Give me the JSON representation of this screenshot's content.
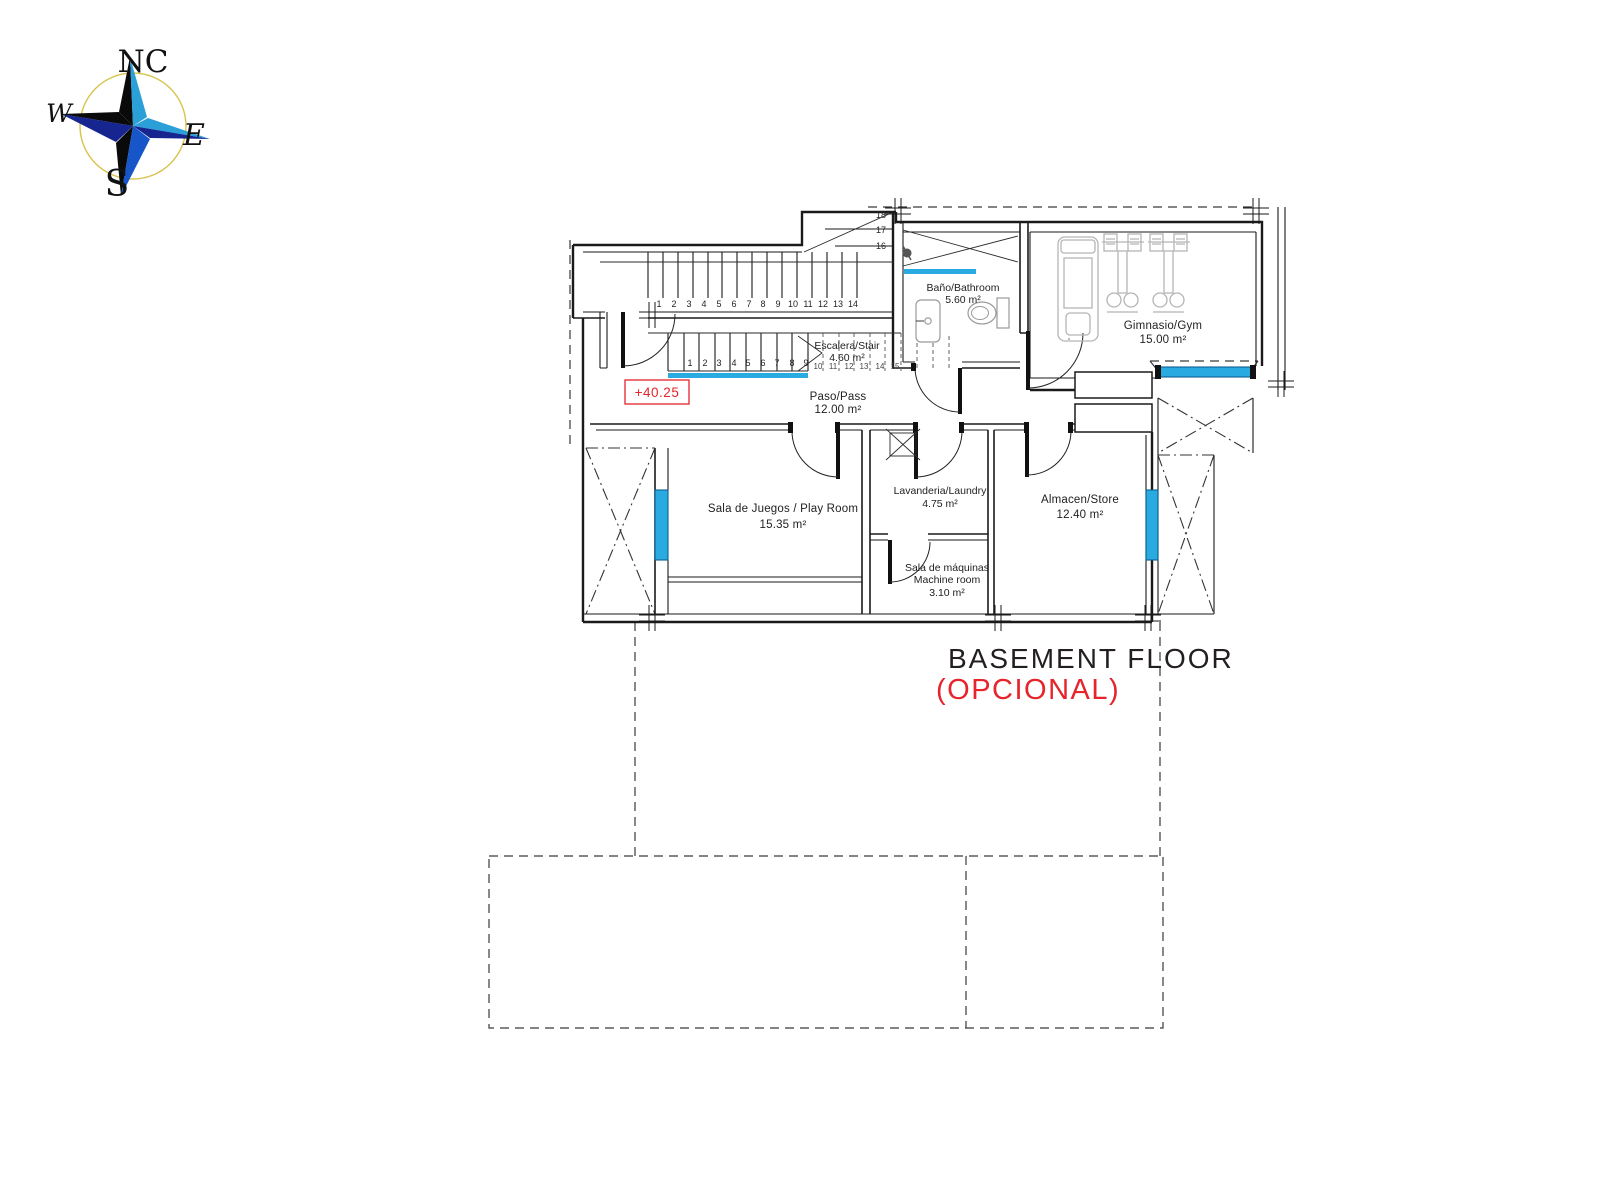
{
  "compass": {
    "n": "NC",
    "w": "W",
    "e": "E",
    "s": "S"
  },
  "plan": {
    "level_marker": "+40.25",
    "rooms": {
      "bathroom": {
        "name": "Baño/Bathroom",
        "area": "5.60 m²"
      },
      "gym": {
        "name": "Gimnasio/Gym",
        "area": "15.00 m²"
      },
      "stair": {
        "name": "Escalera/Stair",
        "area": "4.60 m²"
      },
      "hall": {
        "name": "Paso/Pass",
        "area": "12.00 m²"
      },
      "playroom": {
        "name": "Sala de Juegos / Play Room",
        "area": "15.35 m²"
      },
      "laundry": {
        "name": "Lavanderia/Laundry",
        "area": "4.75 m²"
      },
      "store": {
        "name": "Almacen/Store",
        "area": "12.40 m²"
      },
      "machine": {
        "name": "Sala de máquinas",
        "name2": "Machine room",
        "area": "3.10 m²"
      }
    },
    "stairs": {
      "upper": [
        "1",
        "2",
        "3",
        "4",
        "5",
        "6",
        "7",
        "8",
        "9",
        "10",
        "11",
        "12",
        "13",
        "14"
      ],
      "winder": [
        "18",
        "17",
        "16"
      ],
      "lower": [
        "1",
        "2",
        "3",
        "4",
        "5",
        "6",
        "7",
        "8",
        "9"
      ],
      "lower_hidden": [
        "10",
        "11",
        "12",
        "13",
        "14",
        "15"
      ]
    }
  },
  "title": {
    "main": "BASEMENT FLOOR",
    "sub": "(OPCIONAL)"
  },
  "colors": {
    "wall": "#1a1a1a",
    "window_blue": "#29abe2",
    "accent_red": "#e5242b",
    "equipment_gray": "#b5b5b5",
    "compass_yellow": "#d8c34a",
    "compass_blue": "#2a9fd8",
    "compass_navy": "#16258f"
  }
}
